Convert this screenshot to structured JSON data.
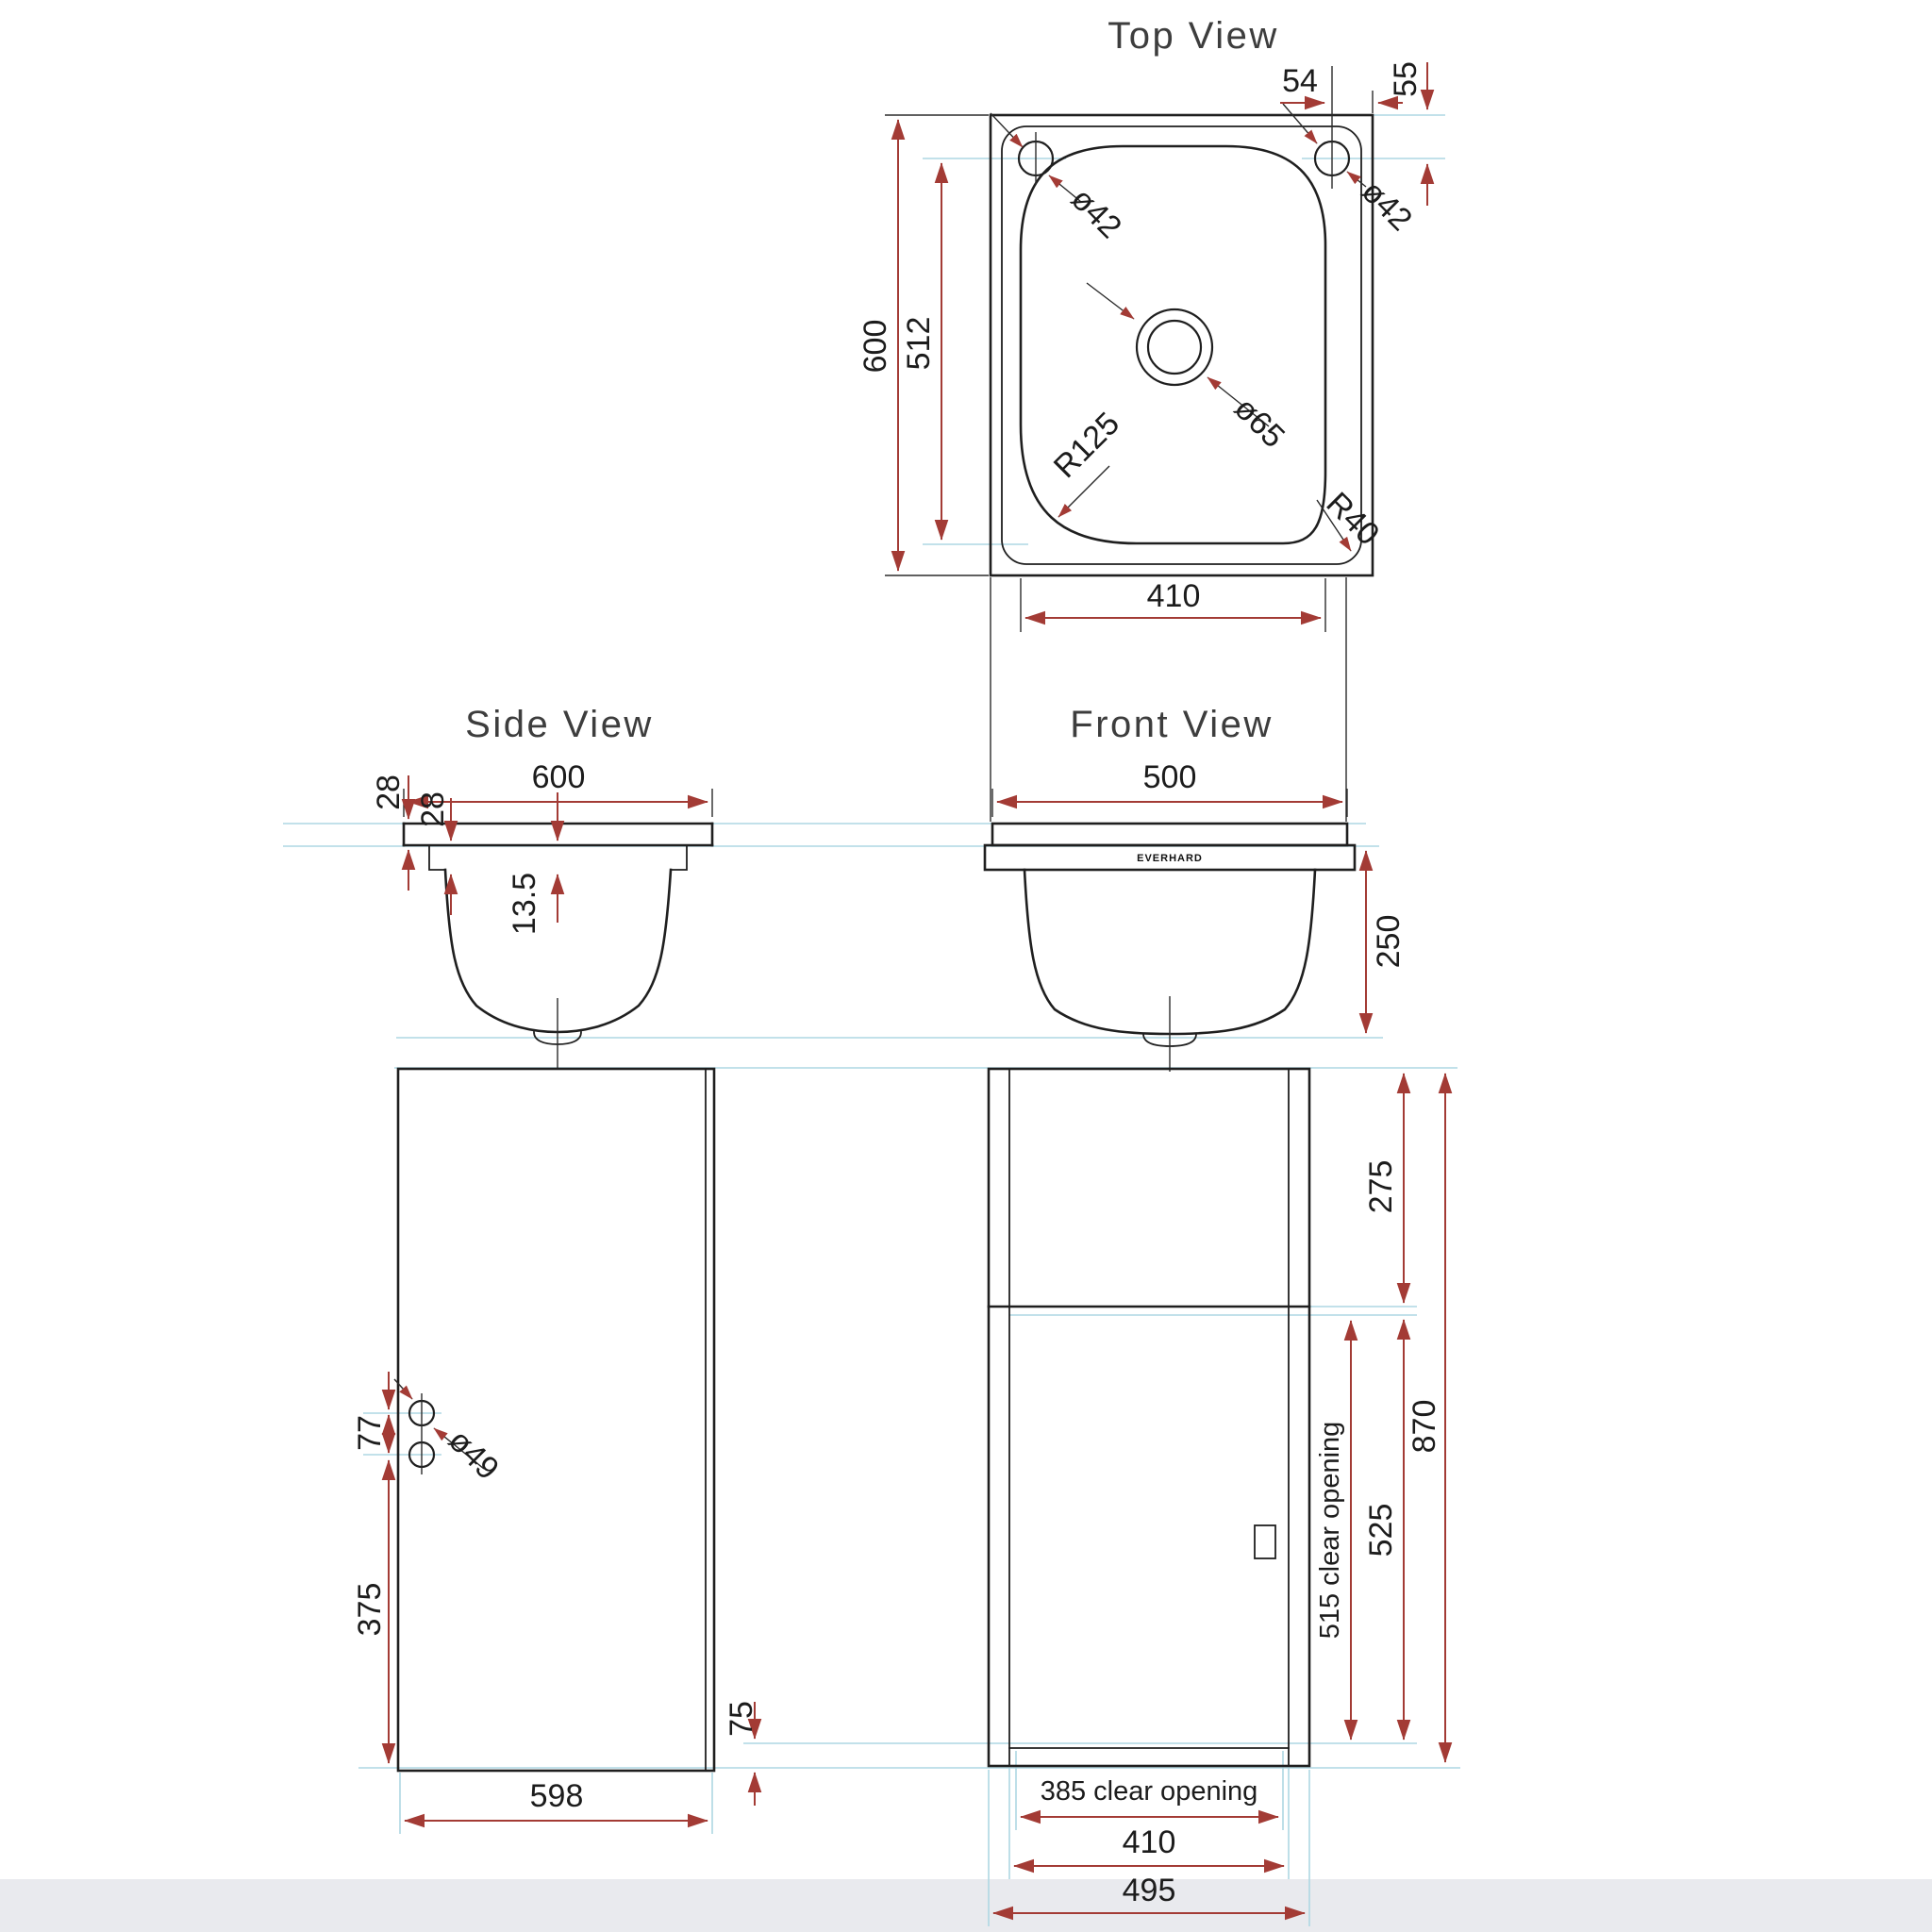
{
  "palette": {
    "background": "#ffffff",
    "line_color": "#1f1f1f",
    "dimension_color": "#a33b35",
    "guide_color": "#aed7e3",
    "footer_band": "#e9eaee",
    "title_color": "#3d3d3d"
  },
  "titles": {
    "top": "Top View",
    "side": "Side View",
    "front": "Front View"
  },
  "top_view": {
    "height": "600",
    "inner_height": "512",
    "tap_left_dia": "ø42",
    "tap_right_dia": "ø42",
    "tap_offset_h": "54",
    "tap_offset_v": "55",
    "drain_dia": "ø65",
    "corner_radius_bl": "R125",
    "corner_radius_br": "R40",
    "bowl_width": "410"
  },
  "side_view": {
    "width": "600",
    "rim_upper": "28",
    "rim_lower": "28",
    "rim_depth": "13.5"
  },
  "front_view": {
    "width": "500",
    "bowl_depth": "250",
    "brand": "EVERHARD"
  },
  "cabinet_side": {
    "hole_spacing": "77",
    "hole_dia": "ø49",
    "hole_height": "375",
    "width": "598"
  },
  "cabinet_front": {
    "top_panel": "275",
    "total_height": "870",
    "door_height": "525",
    "door_clear_height": "515 clear opening",
    "kick_height": "75",
    "door_clear_width": "385 clear opening",
    "door_width": "410",
    "width": "495"
  }
}
